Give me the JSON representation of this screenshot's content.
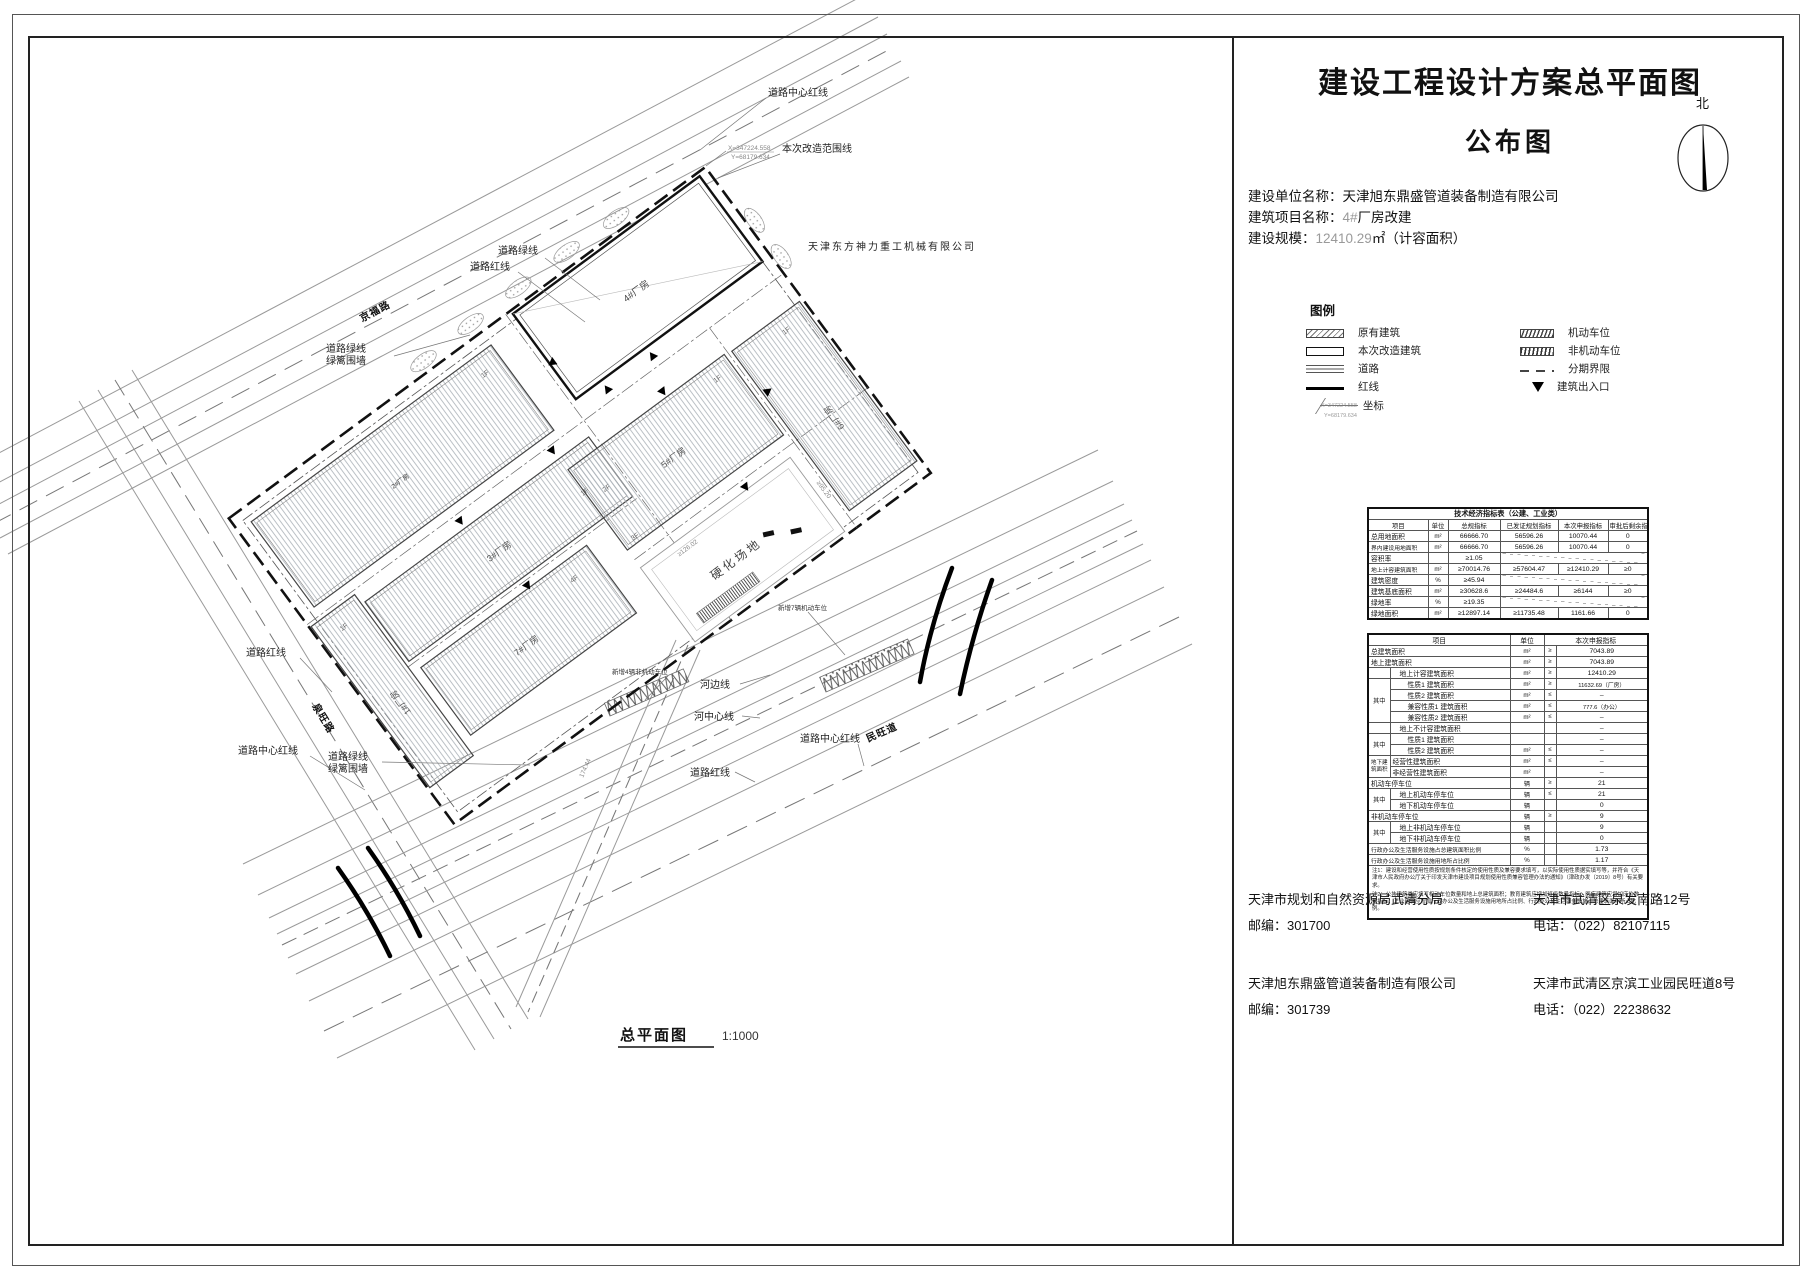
{
  "title_block": {
    "title_line1": "建设工程设计方案总平面图",
    "title_line2": "公布图",
    "north_label": "北",
    "info": [
      {
        "label": "建设单位名称：",
        "gray": "",
        "text": "天津旭东鼎盛管道装备制造有限公司"
      },
      {
        "label": "建筑项目名称：",
        "gray": "4#",
        "text": "厂房改建"
      },
      {
        "label": "建设规模：",
        "gray": "12410.29",
        "text": "㎡（计容面积）"
      }
    ],
    "legend": {
      "title": "图例",
      "existing_building": "原有建筑",
      "renovated_building": "本次改造建筑",
      "road": "道路",
      "red_line": "红线",
      "coordinate": "坐标",
      "motor_parking": "机动车位",
      "non_motor_parking": "非机动车位",
      "phase_boundary": "分期界限",
      "building_entrance": "建筑出入口"
    }
  },
  "table1": {
    "title": "技术经济指标表（公建、工业类）",
    "headers": [
      "项目",
      "单位",
      "总规指标",
      "已发证规划指标",
      "本次申报指标",
      "审批后剩余指标"
    ],
    "rows": [
      [
        "总用地面积",
        "m²",
        "66666.70",
        "56596.26",
        "10070.44",
        "0"
      ],
      [
        "界内建设用地面积",
        "m²",
        "66666.70",
        "56596.26",
        "10070.44",
        "0"
      ],
      [
        "容积率",
        "",
        "≥1.05",
        "",
        "",
        ""
      ],
      [
        "地上计容建筑面积",
        "m²",
        "≥70014.76",
        "≥57604.47",
        "≥12410.29",
        "≥0"
      ],
      [
        "建筑密度",
        "%",
        "≥45.94",
        "",
        "",
        ""
      ],
      [
        "建筑基底面积",
        "m²",
        "≥30628.6",
        "≥24484.6",
        "≥6144",
        "≥0"
      ],
      [
        "绿地率",
        "%",
        "≥19.35",
        "",
        "",
        ""
      ],
      [
        "绿地面积",
        "m²",
        "≥12897.14",
        "≥11735.48",
        "1161.66",
        "0"
      ]
    ]
  },
  "table2": {
    "headers": [
      "项目",
      "单位",
      "本次申报指标"
    ],
    "rows": [
      {
        "g": "",
        "label": "总建筑面积",
        "unit": "m²",
        "cmp": "≥",
        "val": "7043.89"
      },
      {
        "g": "",
        "label": "地上建筑面积",
        "unit": "m²",
        "cmp": "≥",
        "val": "7043.89"
      },
      {
        "g": "",
        "label": "地上计容建筑面积",
        "unit": "m²",
        "cmp": "≥",
        "val": "12410.29"
      },
      {
        "g": "其中",
        "label": "性质1 建筑面积",
        "unit": "m²",
        "cmp": "≥",
        "val": "11632.69（厂房）"
      },
      {
        "g": "",
        "label": "性质2 建筑面积",
        "unit": "m²",
        "cmp": "≤",
        "val": "–"
      },
      {
        "g": "",
        "label": "兼容性质1 建筑面积",
        "unit": "m²",
        "cmp": "≤",
        "val": "777.6（办公）"
      },
      {
        "g": "",
        "label": "兼容性质2 建筑面积",
        "unit": "m²",
        "cmp": "≤",
        "val": "–"
      },
      {
        "g": "",
        "label": "地上不计容建筑面积",
        "unit": "",
        "cmp": "",
        "val": "–"
      },
      {
        "g": "其中",
        "label": "性质1 建筑面积",
        "unit": "",
        "cmp": "",
        "val": "–"
      },
      {
        "g": "",
        "label": "性质2 建筑面积",
        "unit": "m²",
        "cmp": "≤",
        "val": "–"
      },
      {
        "g": "地下建筑面积",
        "label": "经营性建筑面积",
        "unit": "m²",
        "cmp": "≤",
        "val": "–"
      },
      {
        "g": "",
        "label": "非经营性建筑面积",
        "unit": "m²",
        "cmp": "",
        "val": "–"
      },
      {
        "g": "",
        "label": "机动车停车位",
        "unit": "辆",
        "cmp": "≥",
        "val": "21"
      },
      {
        "g": "其中",
        "label": "地上机动车停车位",
        "unit": "辆",
        "cmp": "≤",
        "val": "21"
      },
      {
        "g": "",
        "label": "地下机动车停车位",
        "unit": "辆",
        "cmp": "",
        "val": "0"
      },
      {
        "g": "",
        "label": "非机动车停车位",
        "unit": "辆",
        "cmp": "≥",
        "val": "9"
      },
      {
        "g": "其中",
        "label": "地上非机动车停车位",
        "unit": "辆",
        "cmp": "",
        "val": "9"
      },
      {
        "g": "",
        "label": "地下非机动车停车位",
        "unit": "辆",
        "cmp": "",
        "val": "0"
      },
      {
        "g": "",
        "label": "行政办公及生活服务设施占总建筑面积比例",
        "unit": "%",
        "cmp": "",
        "val": "1.73"
      },
      {
        "g": "",
        "label": "行政办公及生活服务设施用地所占比例",
        "unit": "%",
        "cmp": "",
        "val": "1.17"
      }
    ],
    "notes": [
      "注1：建设和经营使用性质按规划条件核定的使用性质及兼容要求填写，以实际使用性质据实填写等，并符合《天津市人民政府办公厅关于印发天津市建设项目规划使用性质兼容管理办法的通知》（津政办发〔2019〕8号）有关要求。",
      "注2：公共建筑类应填写机动车位数量和地上总建筑面积；教育建筑应增加班级数量指标；医疗建筑应增加床位数量指标；工业建筑应增加行政办公及生活服务设施用地所占比例、行政办公及生活服务设施占总建筑面积所占比例。"
    ]
  },
  "contacts": [
    {
      "name": "天津市规划和自然资源局武清分局",
      "postcode": "邮编：301700",
      "address": "天津市武清区泉发南路12号",
      "phone": "电话：（022）82107115"
    },
    {
      "name": "天津旭东鼎盛管道装备制造有限公司",
      "postcode": "邮编：301739",
      "address": "天津市武清区京滨工业园民旺道8号",
      "phone": "电话：（022）22238632"
    }
  ],
  "plan": {
    "company": "天津东方神力重工机械有限公司",
    "scale_label": "总平面图",
    "scale_value": "1:1000",
    "hard_ground": "硬化场地",
    "labels": {
      "scope": "本次改造范围线",
      "road_center_red": "道路中心红线",
      "road_red": "道路红线",
      "road_green": "道路绿线",
      "hedge": "绿篱围墙",
      "river_edge": "河边线",
      "river_center": "河中心线"
    },
    "buildings": {
      "b1": "1#厂房",
      "b2": "2#厂房",
      "b3": "3#厂房",
      "b4": "4#厂房",
      "b5": "5#厂房",
      "b6": "6#厂房",
      "b7": "7#厂房"
    },
    "floors": {
      "f1": "1F",
      "f2": "2F",
      "f3": "3F",
      "f4": "4F"
    },
    "roads": {
      "top": "京福路",
      "left": "泉旺路",
      "bottom": "民旺道"
    },
    "dims": {
      "d1": "≥126.02",
      "d2": "≥95.20",
      "d3": "174.44"
    },
    "coord": {
      "x": "X=347224.558",
      "y": "Y=68179.634"
    },
    "parking": {
      "p1": "新增7辆机动车位",
      "p2": "新增4辆非机动车位"
    }
  }
}
